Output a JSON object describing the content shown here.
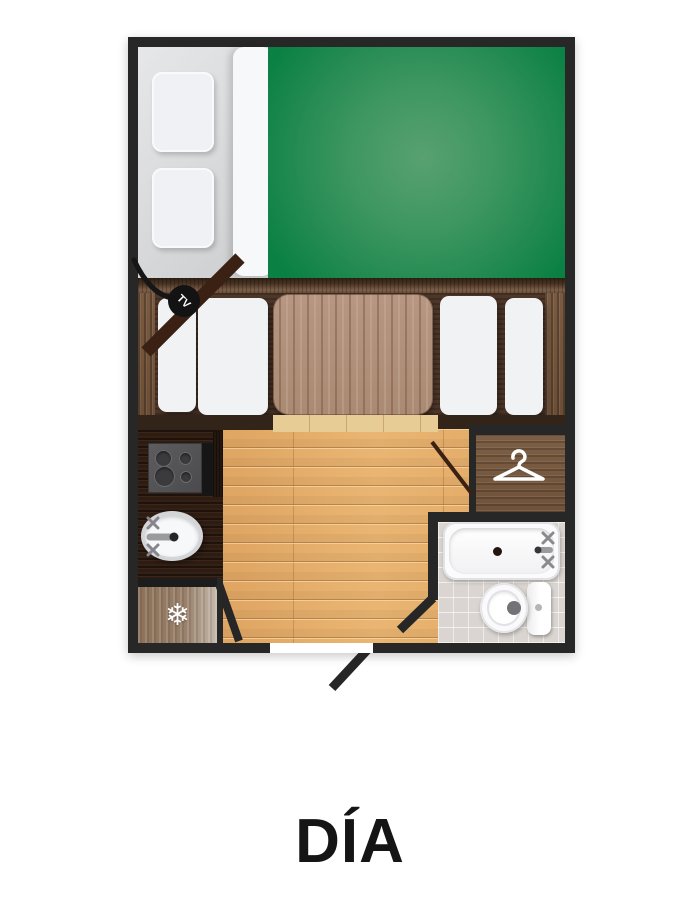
{
  "title": {
    "label": "DÍA"
  },
  "plan": {
    "tv_label": "TV",
    "fridge_icon_glyph": "❄"
  },
  "colors": {
    "wall": "#272727",
    "duvet-center": "#58a170",
    "duvet-edge": "#0a8043",
    "mattress": "#d9dadc",
    "sheet": "#f7f8f9",
    "cushion": "#f0f2f4",
    "bench-wood": "#4e3729",
    "table-wood": "#b2937c",
    "floor-wood": "#e4ac68",
    "counter-wood": "#2c1c12",
    "fridge-wood": "#8d7159",
    "wardrobe-wood": "#7b5d43",
    "tile": "#dad5d0",
    "fixture-white": "#fbfbfd",
    "tv-arm": "#3a2113",
    "title-text": "#151515"
  }
}
